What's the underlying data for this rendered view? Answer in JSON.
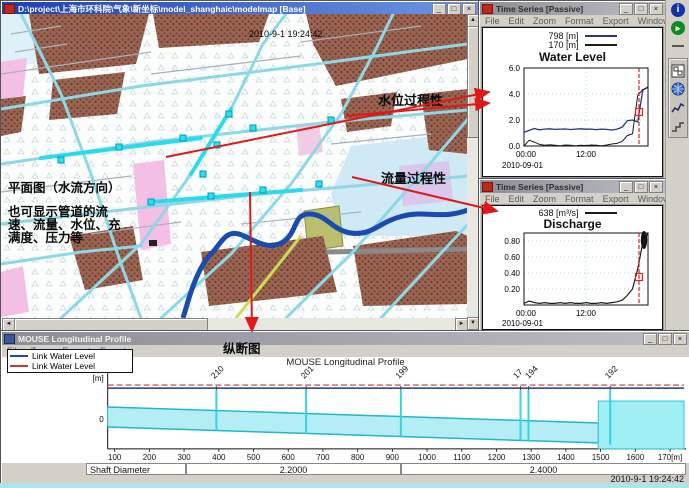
{
  "chrome": {
    "minimize": "_",
    "maximize": "□",
    "close": "×"
  },
  "scroll": {
    "left": "◄",
    "right": "►",
    "up": "▲",
    "down": "▼"
  },
  "map_window": {
    "title": "D:\\project\\上海市环科院\\气象\\新坐标\\model_shanghaic\\modelmap [Base]",
    "timestamp": "2010-9-1 19:24:42",
    "annotations": {
      "water_level_process": "水位过程性",
      "discharge_process": "流量过程性",
      "plan_view": "平面图（水流方向）",
      "pipe_note_line1": "也可显示管道的流",
      "pipe_note_line2": "速、流量、水位、充",
      "pipe_note_line3": "满度、压力等"
    }
  },
  "water_level_window": {
    "title": "Time Series [Passive]",
    "menu": [
      "File",
      "Edit",
      "Zoom",
      "Format",
      "Export",
      "Window"
    ],
    "legend": [
      {
        "label": "798 [m]",
        "color": "#26357f"
      },
      {
        "label": "170 [m]",
        "color": "#1c1c1c"
      }
    ],
    "chart_title": "Water Level",
    "y_ticks": [
      "6.0",
      "4.0",
      "2.0",
      "0.0"
    ],
    "x_ticks": [
      "00:00",
      "12:00"
    ],
    "x_date": "2010-09-01"
  },
  "discharge_window": {
    "title": "Time Series [Passive]",
    "menu": [
      "File",
      "Edit",
      "Zoom",
      "Format",
      "Export",
      "Window"
    ],
    "legend": [
      {
        "label": "638 [m³/s]",
        "color": "#1c1c1c"
      }
    ],
    "chart_title": "Discharge",
    "y_ticks": [
      "0.80",
      "0.60",
      "0.40",
      "0.20"
    ],
    "x_ticks": [
      "00:00",
      "12:00"
    ],
    "x_date": "2010-09-01"
  },
  "profile_window": {
    "title": "MOUSE Longitudinal Profile",
    "menu": [
      "File",
      "Zoom",
      "Format",
      "Export"
    ],
    "section_label": "纵断图",
    "legend": [
      {
        "label": "Link Water Level",
        "color": "#2244bb"
      },
      {
        "label": "Link Water Level",
        "color": "#cc3333"
      }
    ],
    "chart_title": "MOUSE Longitudinal Profile",
    "unit_label": "[m]",
    "y_tick": "0",
    "node_labels": [
      "210",
      "201",
      "199",
      "17",
      "194",
      "192"
    ],
    "x_ticks": [
      "100",
      "200",
      "300",
      "400",
      "500",
      "600",
      "700",
      "800",
      "900",
      "1000",
      "1100",
      "1200",
      "1300",
      "1400",
      "1500",
      "1600",
      "170[m]"
    ],
    "table": {
      "header": "Shaft Diameter",
      "values": [
        "2.2000",
        "2.4000"
      ]
    },
    "timestamp": "2010-9-1 19:24:42"
  },
  "toolbar": {
    "icons": [
      "info-icon",
      "run-icon",
      "separator",
      "select-icon",
      "globe-icon",
      "profile-icon",
      "steps-icon"
    ]
  },
  "chart_data": [
    {
      "type": "line",
      "title": "Water Level",
      "ylabel": "[m]",
      "x_hours": [
        0,
        1,
        2,
        3,
        4,
        5,
        6,
        7,
        8,
        9,
        10,
        11,
        12,
        13,
        14,
        15,
        16,
        17,
        18,
        19,
        20,
        21,
        22,
        23,
        24
      ],
      "x_date": "2010-09-01",
      "x_tick_labels": [
        "00:00",
        "12:00"
      ],
      "ylim": [
        -0.5,
        6.5
      ],
      "y_ticks": [
        0.0,
        2.0,
        4.0,
        6.0
      ],
      "series": [
        {
          "name": "798 [m]",
          "color": "#26357f",
          "values": [
            1.05,
            1.2,
            1.35,
            1.25,
            1.3,
            1.32,
            1.28,
            1.3,
            1.31,
            1.27,
            1.3,
            1.32,
            1.29,
            1.3,
            1.26,
            1.3,
            1.28,
            1.22,
            1.3,
            1.45,
            1.95,
            2.0,
            1.85,
            4.3,
            4.55
          ]
        },
        {
          "name": "170 [m]",
          "color": "#1c1c1c",
          "values": [
            0.0,
            0.45,
            0.3,
            0.12,
            0.05,
            0.1,
            0.06,
            0.02,
            0.08,
            0.05,
            0.02,
            0.06,
            0.04,
            0.08,
            0.05,
            0.02,
            0.08,
            0.15,
            0.2,
            0.35,
            0.8,
            0.95,
            3.9,
            4.35,
            4.5
          ]
        }
      ],
      "cursor": {
        "style": "red-dashed-vline",
        "x_hour": 22.25
      },
      "marker": {
        "style": "red-square",
        "x_hour": 22.25,
        "value": 2.6
      }
    },
    {
      "type": "line",
      "title": "Discharge",
      "ylabel": "[m³/s]",
      "x_hours": [
        0,
        1,
        2,
        3,
        4,
        5,
        6,
        7,
        8,
        9,
        10,
        11,
        12,
        13,
        14,
        15,
        16,
        17,
        18,
        19,
        20,
        21,
        22,
        23,
        24
      ],
      "x_date": "2010-09-01",
      "x_tick_labels": [
        "00:00",
        "12:00"
      ],
      "ylim": [
        0,
        1.0
      ],
      "y_ticks": [
        0.2,
        0.4,
        0.6,
        0.8
      ],
      "series": [
        {
          "name": "638 [m³/s]",
          "color": "#1c1c1c",
          "values": [
            0.02,
            0.05,
            0.03,
            0.02,
            0.03,
            0.02,
            0.02,
            0.03,
            0.02,
            0.03,
            0.02,
            0.02,
            0.03,
            0.02,
            0.02,
            0.03,
            0.02,
            0.03,
            0.04,
            0.06,
            0.12,
            0.2,
            0.45,
            0.78,
            0.9
          ]
        }
      ],
      "cursor": {
        "style": "red-dashed-vline",
        "x_hour": 22.25
      },
      "marker": {
        "style": "red-square",
        "x_hour": 22.25,
        "value": 0.35
      }
    },
    {
      "type": "area",
      "title": "MOUSE Longitudinal Profile",
      "x_axis_unit": "[m]",
      "x_range": [
        0,
        1700
      ],
      "x_tick_step": 100,
      "y_tick": 0,
      "nodes": [
        {
          "label": "210",
          "chainage": 390
        },
        {
          "label": "201",
          "chainage": 650
        },
        {
          "label": "199",
          "chainage": 920
        },
        {
          "label": "17",
          "chainage": 1260
        },
        {
          "label": "194",
          "chainage": 1290
        },
        {
          "label": "192",
          "chainage": 1520
        }
      ],
      "series": [
        {
          "name": "Link Water Level",
          "color": "blue"
        },
        {
          "name": "Link Water Level",
          "color": "red"
        }
      ],
      "shaft_diameter": [
        {
          "value": "2.2000",
          "x_span": [
            0,
            700
          ]
        },
        {
          "value": "2.4000",
          "x_span": [
            700,
            1700
          ]
        }
      ]
    }
  ]
}
